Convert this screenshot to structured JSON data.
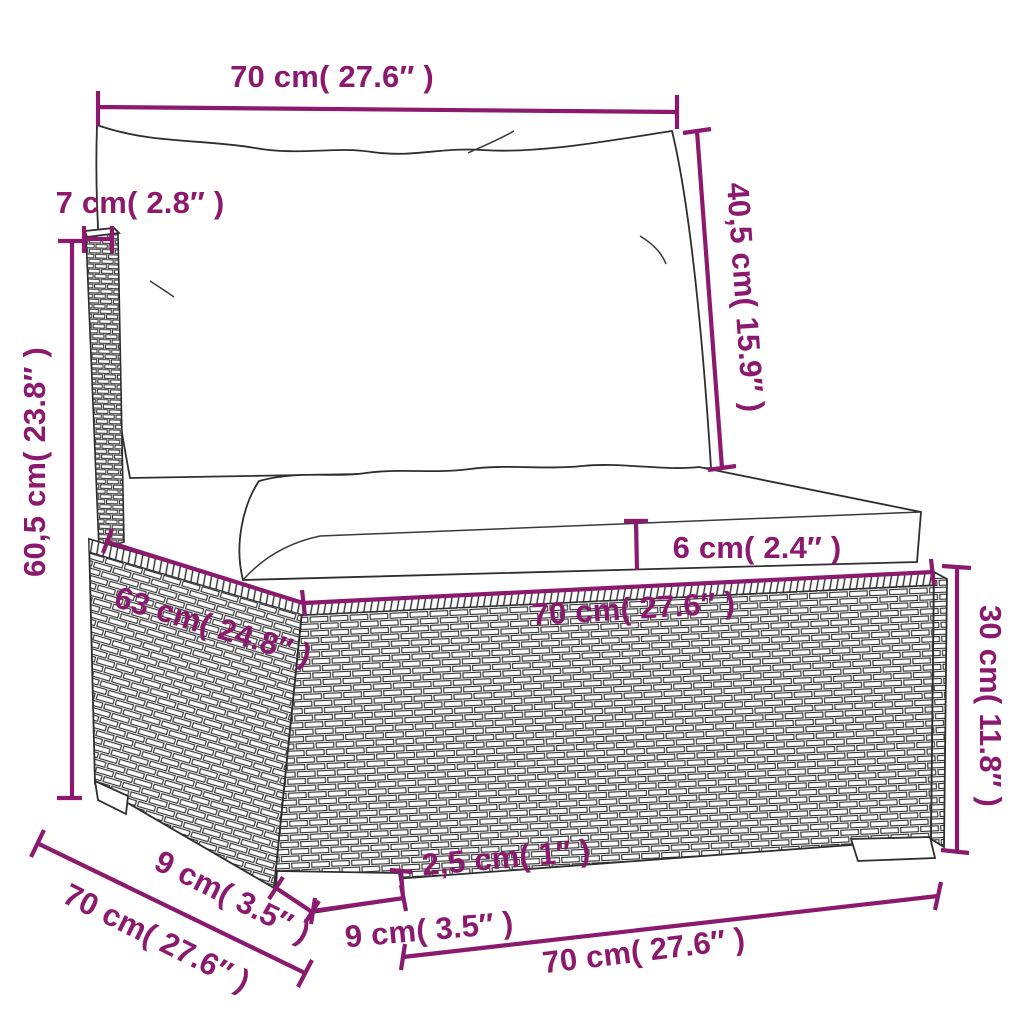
{
  "diagram": {
    "type": "furniture-dimension-diagram",
    "subject": "Poly rattan garden sofa middle section with back and seat cushions, line-art dimension drawing",
    "accent_color": "#8B1A6E",
    "outline_color": "#2e2e2e",
    "background_color": "#ffffff",
    "units": {
      "metric": "cm",
      "imperial": "inches"
    },
    "dimensions": [
      {
        "id": "back-cushion-width",
        "label": "70 cm( 27.6″ )",
        "cm": "70",
        "inches": "27.6",
        "orientation": "horizontal",
        "measures": "back cushion width (top)"
      },
      {
        "id": "back-panel-thickness",
        "label": "7 cm( 2.8″ )",
        "cm": "7",
        "inches": "2.8",
        "orientation": "horizontal",
        "measures": "backrest panel thickness"
      },
      {
        "id": "back-cushion-height",
        "label": "40,5 cm( 15.9″ )",
        "cm": "40,5",
        "inches": "15.9",
        "orientation": "vertical",
        "measures": "back cushion height"
      },
      {
        "id": "backrest-height",
        "label": "60,5 cm( 23.8″ )",
        "cm": "60,5",
        "inches": "23.8",
        "orientation": "vertical",
        "measures": "backrest height from ground"
      },
      {
        "id": "seat-cushion-thickness",
        "label": "6 cm( 2.4″ )",
        "cm": "6",
        "inches": "2.4",
        "orientation": "vertical",
        "measures": "seat cushion thickness"
      },
      {
        "id": "seat-depth-top",
        "label": "63 cm( 24.8″ )",
        "cm": "63",
        "inches": "24.8",
        "orientation": "diagonal",
        "measures": "base depth along top side edge"
      },
      {
        "id": "seat-width-front",
        "label": "70 cm( 27.6″ )",
        "cm": "70",
        "inches": "27.6",
        "orientation": "horizontal",
        "measures": "base width along top front edge"
      },
      {
        "id": "base-height",
        "label": "30 cm( 11.8″ )",
        "cm": "30",
        "inches": "11.8",
        "orientation": "vertical",
        "measures": "rattan base height"
      },
      {
        "id": "foot-height",
        "label": "2,5 cm( 1″ )",
        "cm": "2,5",
        "inches": "1",
        "orientation": "vertical",
        "measures": "foot height"
      },
      {
        "id": "foot-depth-side",
        "label": "9 cm( 3.5″ )",
        "cm": "9",
        "inches": "3.5",
        "orientation": "diagonal",
        "measures": "foot depth (side)"
      },
      {
        "id": "foot-width-front",
        "label": "9 cm( 3.5″ )",
        "cm": "9",
        "inches": "3.5",
        "orientation": "horizontal",
        "measures": "foot width (front)"
      },
      {
        "id": "overall-depth-bottom",
        "label": "70 cm( 27.6″ )",
        "cm": "70",
        "inches": "27.6",
        "orientation": "diagonal",
        "measures": "overall depth along bottom side edge"
      },
      {
        "id": "overall-width-bottom",
        "label": "70 cm( 27.6″ )",
        "cm": "70",
        "inches": "27.6",
        "orientation": "horizontal",
        "measures": "overall width along bottom front edge"
      }
    ]
  }
}
